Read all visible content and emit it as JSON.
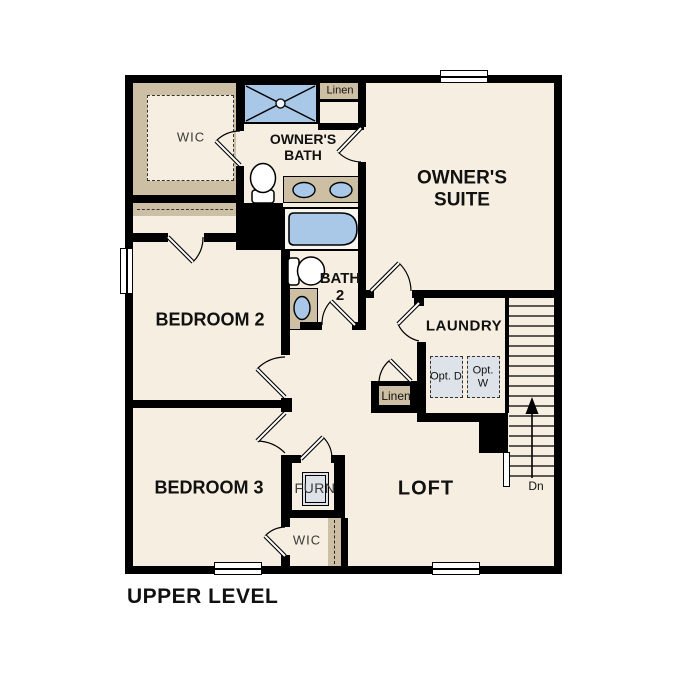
{
  "title": "UPPER LEVEL",
  "colors": {
    "floor": "#f6eee1",
    "shelf_tan": "#cdbfa3",
    "fixture_blue": "#a9c8e8",
    "wall": "#000000",
    "appliance_gray": "#dde3e8"
  },
  "rooms": {
    "wic_master": {
      "label": "WIC"
    },
    "owners_bath": {
      "label": "OWNER'S BATH"
    },
    "linen_top": {
      "label": "Linen"
    },
    "owners_suite": {
      "label": "OWNER'S SUITE"
    },
    "bedroom2": {
      "label": "BEDROOM 2"
    },
    "bath2": {
      "label": "BATH 2"
    },
    "laundry": {
      "label": "LAUNDRY"
    },
    "opt_dryer": {
      "label": "Opt. D"
    },
    "opt_washer": {
      "label": "Opt. W"
    },
    "linen_hall": {
      "label": "Linen"
    },
    "bedroom3": {
      "label": "BEDROOM 3"
    },
    "furnace": {
      "label": "FURN"
    },
    "loft": {
      "label": "LOFT"
    },
    "wic_bedroom3": {
      "label": "WIC"
    },
    "stairs_direction": {
      "label": "Dn"
    }
  }
}
